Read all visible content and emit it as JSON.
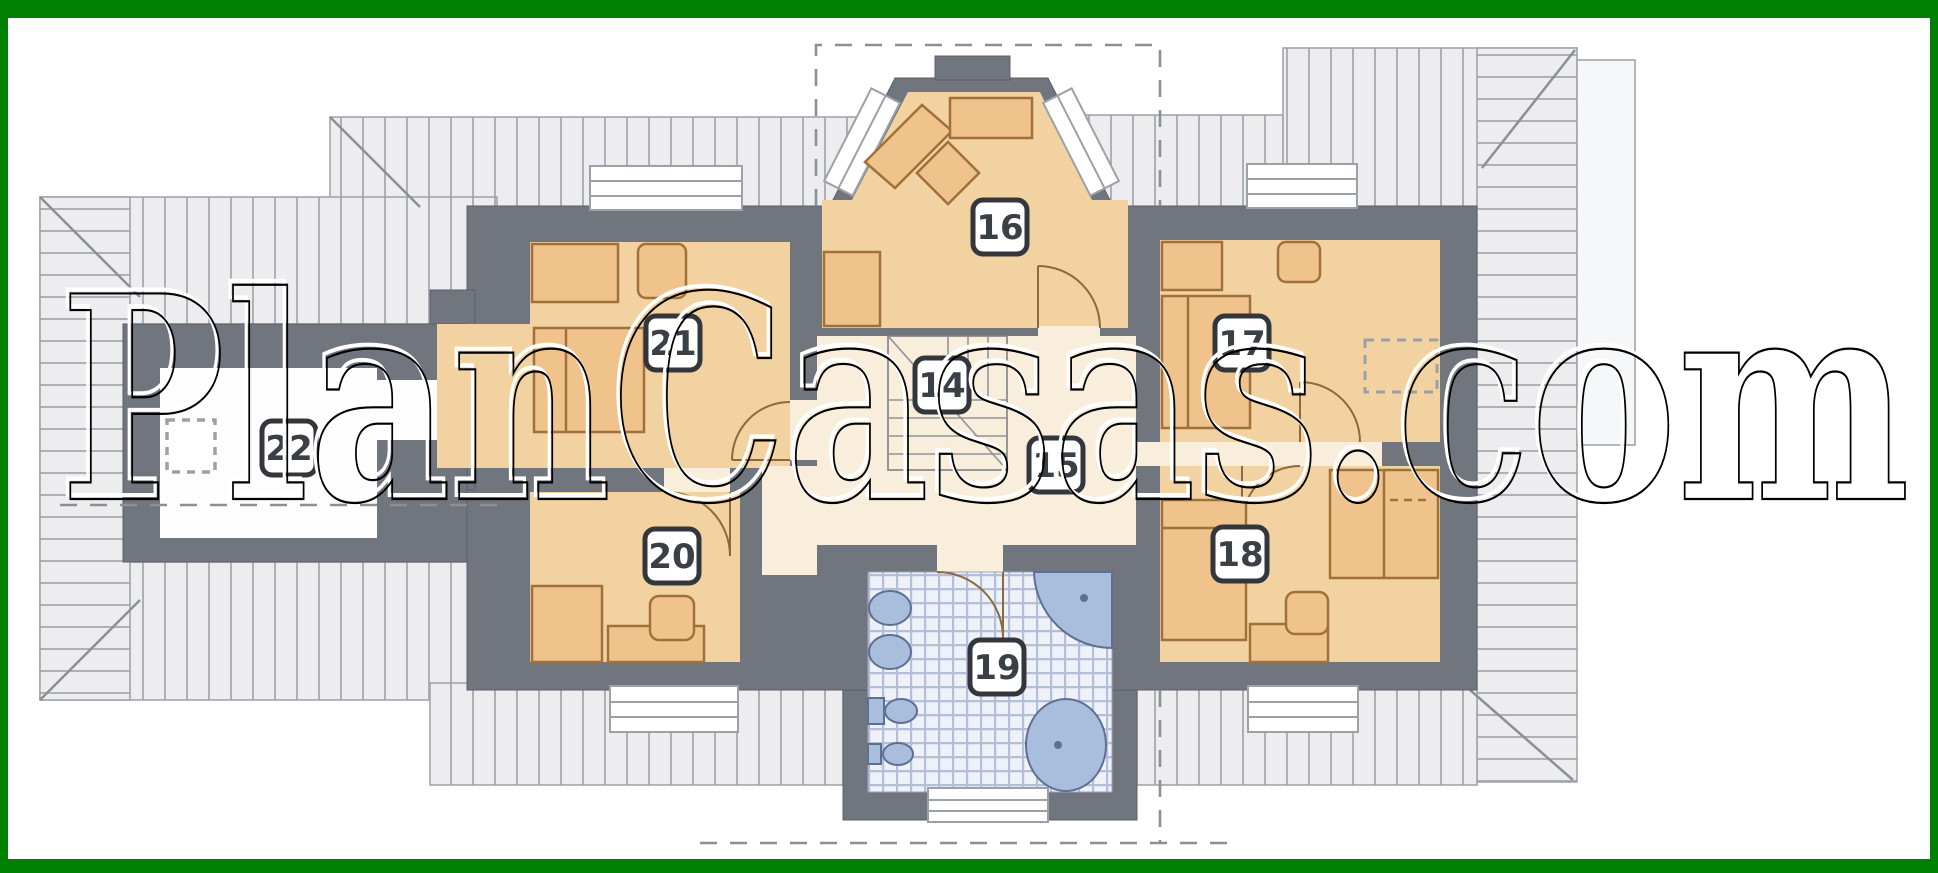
{
  "watermark": {
    "text": "PlanCasas.com"
  },
  "rooms": {
    "r14": {
      "label": "14"
    },
    "r15": {
      "label": "15"
    },
    "r16": {
      "label": "16"
    },
    "r17": {
      "label": "17"
    },
    "r18": {
      "label": "18"
    },
    "r19": {
      "label": "19"
    },
    "r20": {
      "label": "20"
    },
    "r21": {
      "label": "21"
    },
    "r22": {
      "label": "22"
    }
  },
  "colors": {
    "frame_green": "#008000",
    "wall_gray": "#71757e",
    "room_tan": "#f3d2a2",
    "hall_cream": "#f8eedb",
    "terrace_white": "#fdfdfe",
    "furniture_tan": "#f0c38d",
    "furniture_outline": "#a1713b",
    "roof_fill": "#ededef",
    "roof_line": "#acb1b6",
    "tile_base": "#eef1f7",
    "tile_line": "#b3bfd8",
    "fixture_blue": "#a9bedd",
    "badge_border": "#33373c"
  }
}
